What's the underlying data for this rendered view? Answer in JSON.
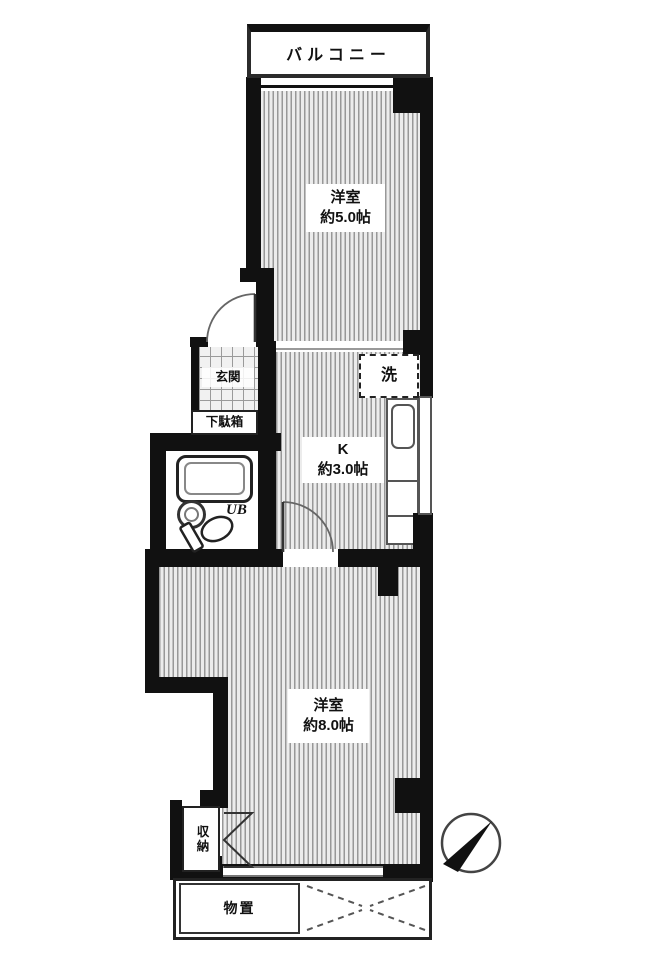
{
  "floorplan": {
    "balcony_label": "バルコニー",
    "room_upper": {
      "name": "洋室",
      "size": "約5.0帖"
    },
    "entrance_label": "玄関",
    "shoe_cabinet_label": "下駄箱",
    "laundry_label": "洗",
    "kitchen": {
      "name": "K",
      "size": "約3.0帖"
    },
    "unit_bath_label": "UB",
    "room_lower": {
      "name": "洋室",
      "size": "約8.0帖"
    },
    "closet_label": "収納",
    "storage_label": "物置",
    "north_arrow_direction": "northeast",
    "colors": {
      "wall": "#111111",
      "floor_stripe": "#989898",
      "floor_bg": "#ececec",
      "outline": "#333333"
    }
  }
}
